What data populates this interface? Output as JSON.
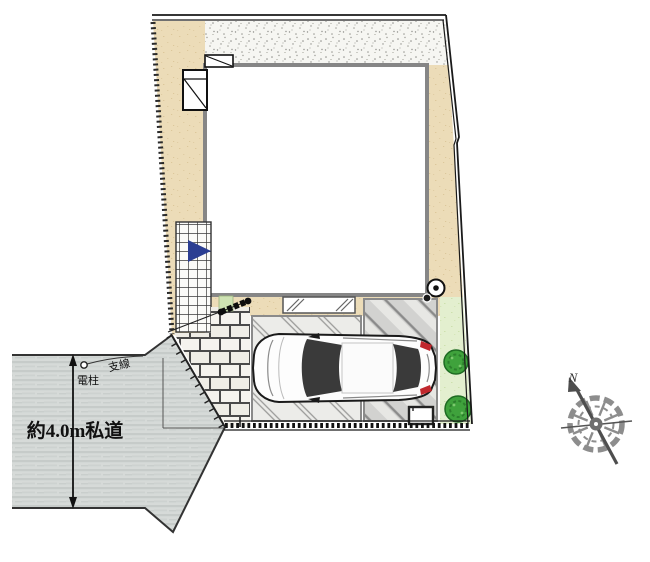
{
  "drawing": {
    "type": "real-estate site plan (top view)",
    "labels": {
      "road_width": "約4.0m私道",
      "utility_pole": "電柱",
      "guy_wire": "支線",
      "compass_north": "N"
    },
    "symbols": [
      {
        "name": "car-topview",
        "desc": "white sedan parked facing left"
      },
      {
        "name": "compass-rose",
        "desc": "ship-wheel compass, needle pointing upper-left to N"
      },
      {
        "name": "entrance-arrow",
        "desc": "blue triangle on tiled entrance steps"
      },
      {
        "name": "gate",
        "desc": "black gate bar at approach"
      },
      {
        "name": "utility-pole-plot",
        "desc": "circle-with-dot pole at parking corner"
      },
      {
        "name": "utility-pole-road",
        "desc": "small circle pole on road"
      },
      {
        "name": "shrub",
        "desc": "two round green shrubs along east boundary"
      },
      {
        "name": "meter-box",
        "desc": "small white box at parking south edge"
      }
    ],
    "colors": {
      "beige_strip": "#ecdcb8",
      "stipple_bg": "#f6f6f2",
      "road_gray": "#d6dad8",
      "parking_light": "#ecece9",
      "parking_dark": "#d2d2d0",
      "arrow_blue": "#2b3e92",
      "shrub_green": "#3fa23c",
      "planting_green": "#e3efcf",
      "outline_black": "#1a1a1a",
      "building_outline_gray": "#868686"
    }
  }
}
